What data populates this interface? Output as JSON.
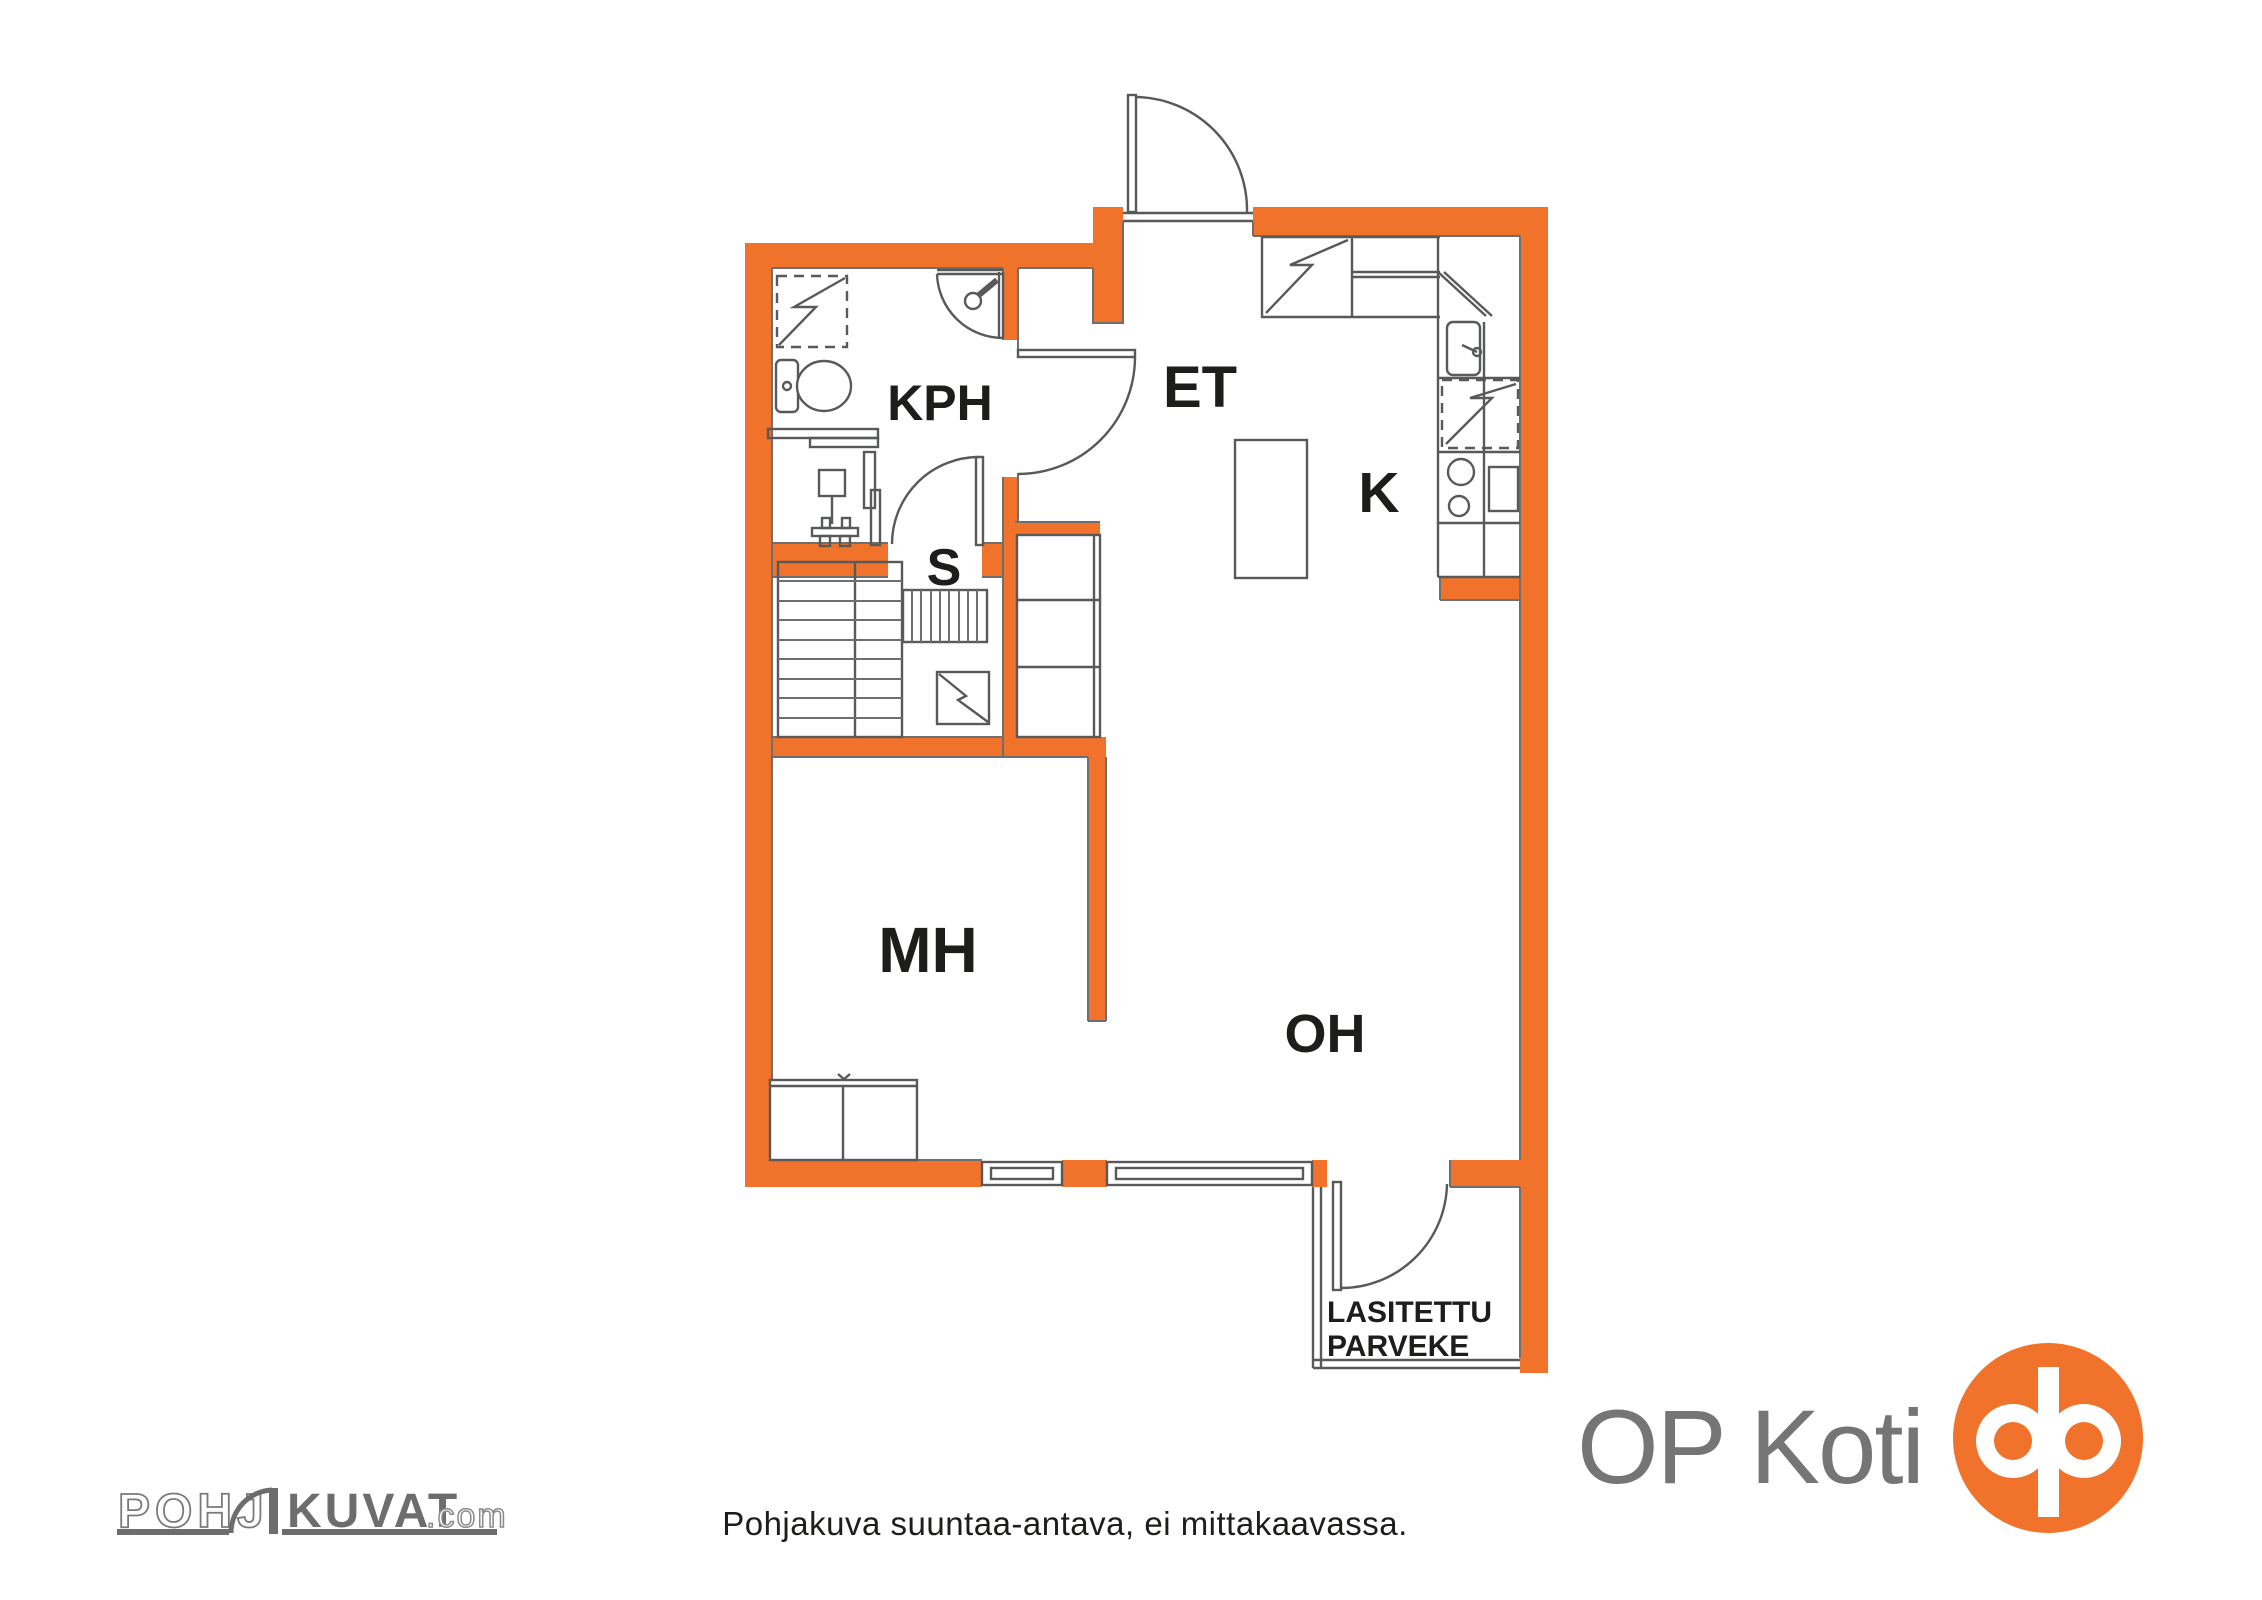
{
  "plan": {
    "rooms": {
      "kph": {
        "label": "KPH"
      },
      "et": {
        "label": "ET"
      },
      "k": {
        "label": "K"
      },
      "s": {
        "label": "S"
      },
      "mh": {
        "label": "MH"
      },
      "oh": {
        "label": "OH"
      }
    },
    "balcony": {
      "line1": "LASITETTU",
      "line2": "PARVEKE"
    }
  },
  "footer": {
    "pohjakuvat_logo": {
      "outlined": "POHJ",
      "solid": "KUVAT",
      "suffix": ".com",
      "door_icon": "door-arc-icon"
    },
    "disclaimer": "Pohjakuva suuntaa-antava, ei mittakaavassa.",
    "op_koti": {
      "wordmark": "OP Koti",
      "logo_icon": "op-logo-icon"
    }
  },
  "colors": {
    "wall_orange": "#F0722B",
    "line_gray": "#58595B",
    "label_black": "#1D1D1B",
    "logo_gray": "#6D6D6D",
    "op_text_gray": "#757575"
  }
}
